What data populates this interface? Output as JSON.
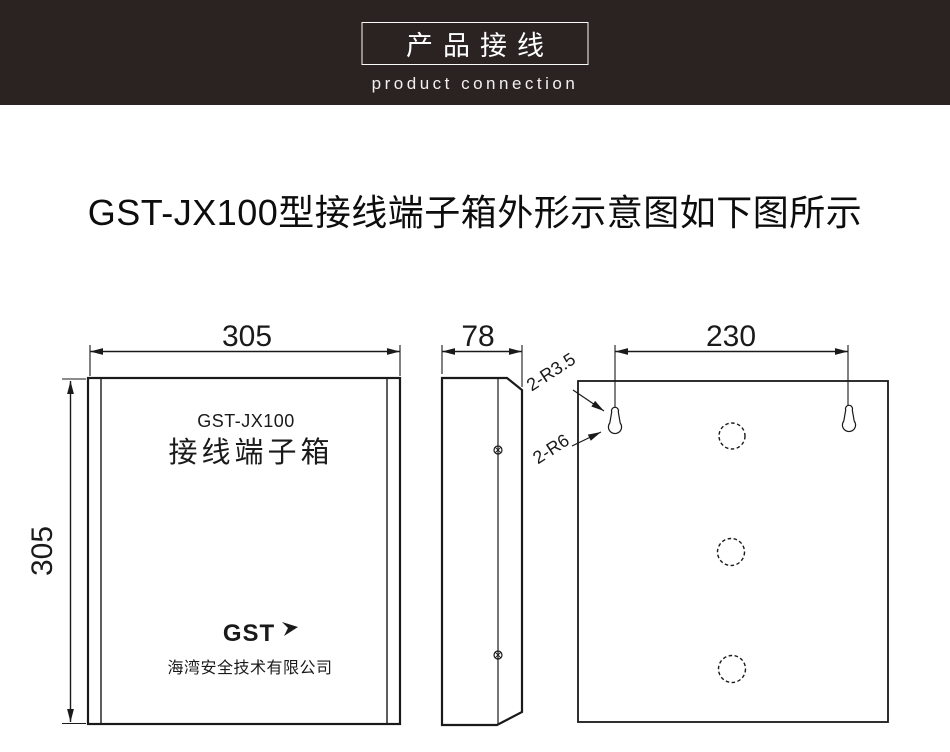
{
  "header": {
    "title": "产品接线",
    "subtitle": "product connection",
    "bg_color": "#2A2322",
    "text_color": "#FFFFFF"
  },
  "page_title": "GST-JX100型接线端子箱外形示意图如下图所示",
  "drawing": {
    "line_color": "#1A1A1A",
    "front_view": {
      "width_dim": "305",
      "height_dim": "305",
      "model_label": "GST-JX100",
      "product_label": "接线端子箱",
      "logo": "GST",
      "company": "海湾安全技术有限公司"
    },
    "side_view": {
      "depth_dim": "78"
    },
    "back_view": {
      "hole_spacing_dim": "230",
      "keyhole_small_note": "2-R3.5",
      "keyhole_large_note": "2-R6"
    }
  }
}
